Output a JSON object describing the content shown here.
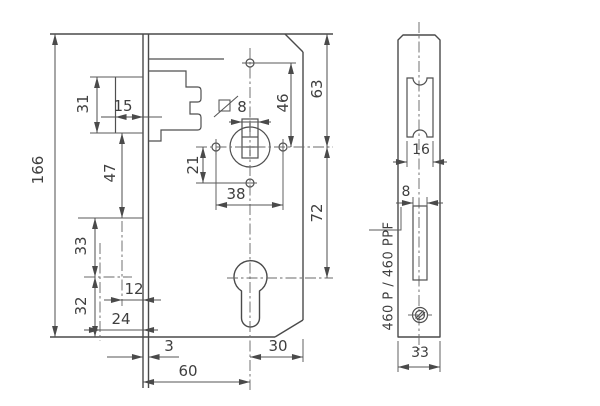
{
  "drawing": {
    "background_color": "#ffffff",
    "line_color": "#4a4a4a",
    "product_label": "460 P / 460 PPF",
    "main_view": {
      "overall_height": "166",
      "latch_cutout_height": "31",
      "latch_protrusion": "15",
      "latch_to_axis": "47",
      "axis_block_upper": "33",
      "cylinder_to_bottom": "32",
      "hole_depth_near": "12",
      "hole_depth_far": "24",
      "faceplate_stand_off": "3",
      "backset": "60",
      "cylinder_to_back_edge": "30",
      "spindle_square": "8",
      "hub_to_top_hole": "46",
      "top_to_hub": "63",
      "hub_to_cylinder": "72",
      "hub_to_lower_hole": "21",
      "fixing_hole_spacing": "38"
    },
    "face_view": {
      "latch_cutout_width": "16",
      "cylinder_slot_width": "8",
      "faceplate_width": "33"
    }
  }
}
